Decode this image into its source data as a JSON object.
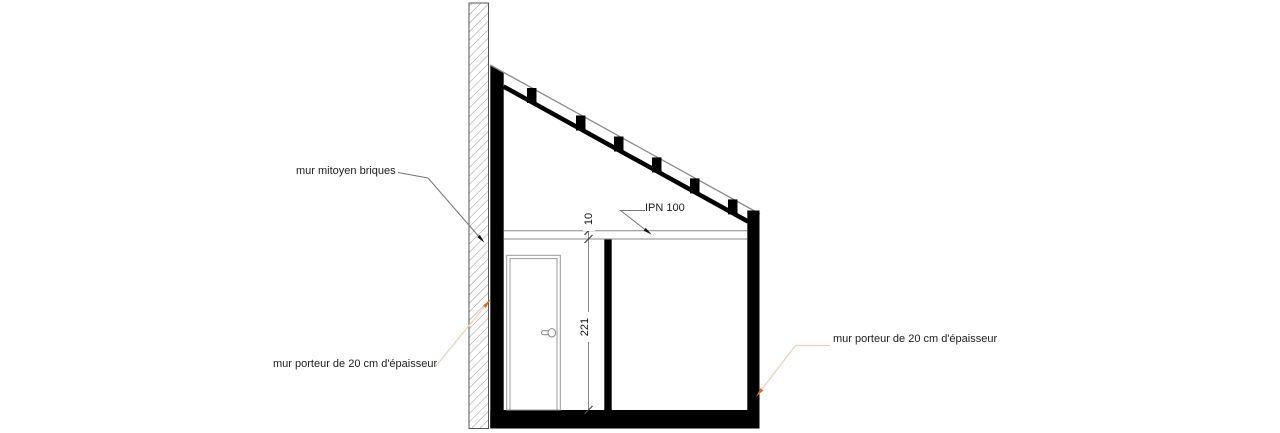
{
  "drawing": {
    "title": "coupe - section drawing",
    "labels": {
      "party_wall": "mur mitoyen briques",
      "bearing_wall_left": "mur porteur de 20 cm d'épaisseur",
      "bearing_wall_right": "mur porteur de 20 cm d'épaisseur",
      "beam": "IPN 100"
    },
    "dimensions": {
      "beam_height_cm": "10",
      "room_height_cm": "221"
    },
    "colors": {
      "ink": "#000000",
      "thin_line": "#8a8a8a",
      "hatch_line": "#9a9a9a",
      "leader_orange_line": "#f2cfb5",
      "arrow_orange": "#d96c1f"
    }
  }
}
